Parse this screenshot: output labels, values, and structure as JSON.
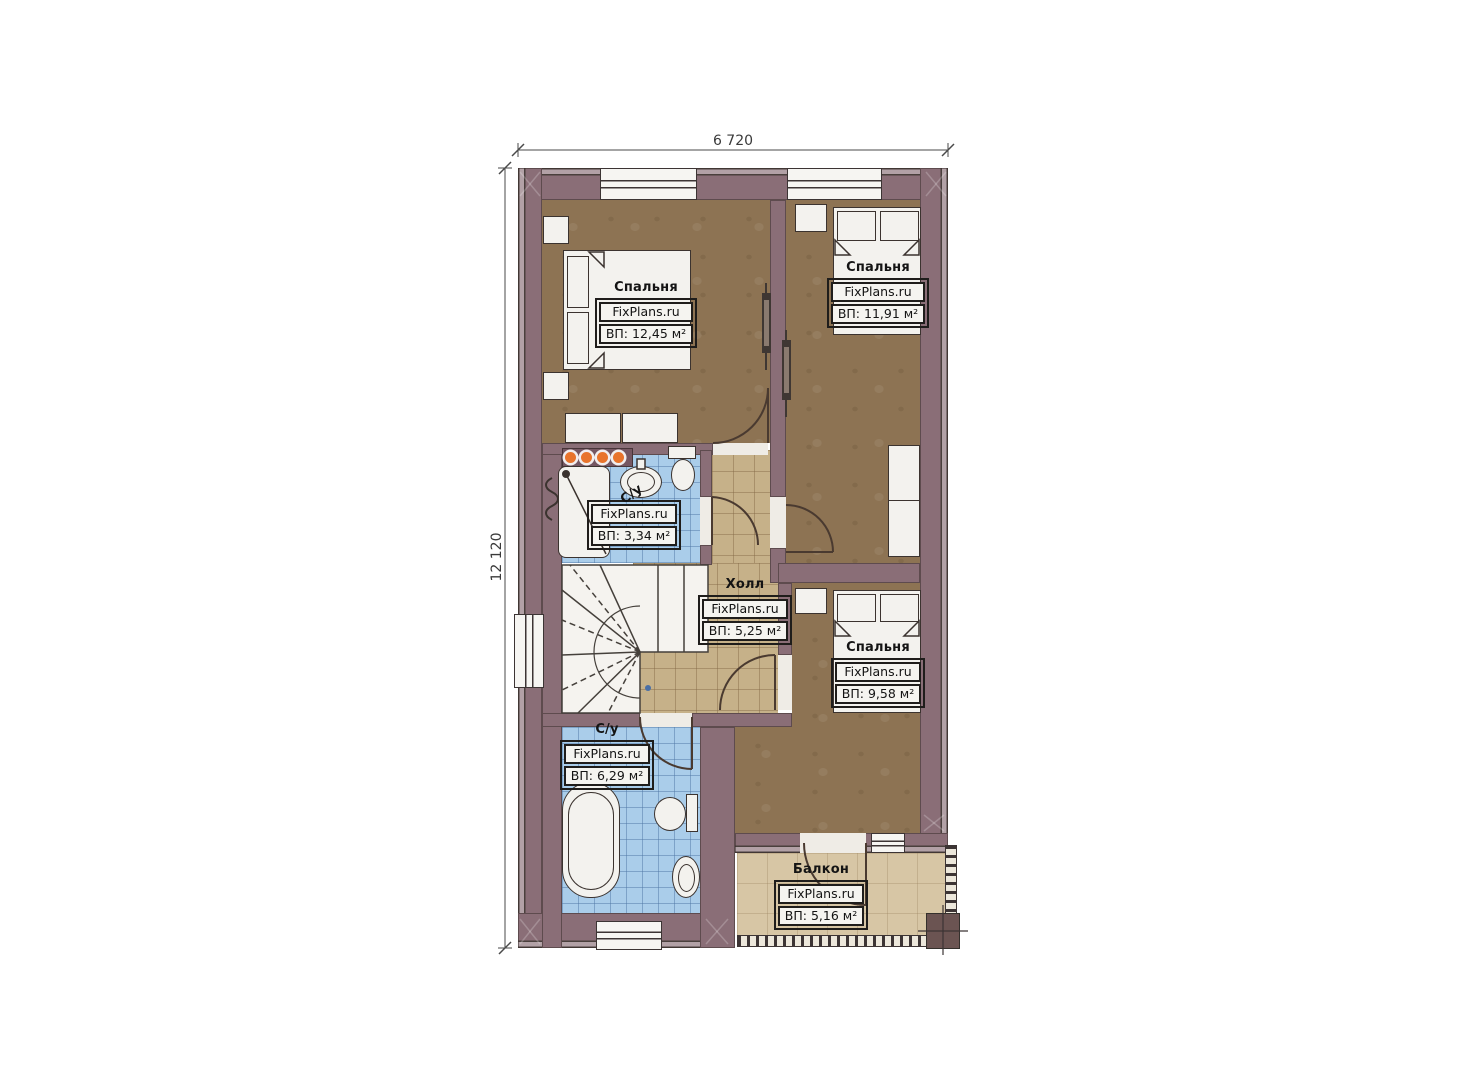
{
  "plan_title": "floor-plan-second-level",
  "brand": "FixPlans.ru",
  "dimensions": {
    "width_label": "6 720",
    "height_label": "12 120"
  },
  "colors": {
    "wall": "#8a6e77",
    "wood_floor": "#8d7353",
    "hall_tile": "#c6b189",
    "bath_tile": "#aacdea",
    "balcony_floor": "#d7c6a5",
    "spotlight_accent": "#e8742c"
  },
  "rooms": {
    "bedroom_top_left": {
      "name": "Спальня",
      "brand": "FixPlans.ru",
      "area": "ВП: 12,45 м²"
    },
    "bedroom_top_right": {
      "name": "Спальня",
      "brand": "FixPlans.ru",
      "area": "ВП: 11,91 м²"
    },
    "bathroom_small": {
      "name": "С/у",
      "brand": "FixPlans.ru",
      "area": "ВП: 3,34 м²"
    },
    "hall": {
      "name": "Холл",
      "brand": "FixPlans.ru",
      "area": "ВП: 5,25 м²"
    },
    "bedroom_bottom_right": {
      "name": "Спальня",
      "brand": "FixPlans.ru",
      "area": "ВП: 9,58 м²"
    },
    "bathroom_big": {
      "name": "С/у",
      "brand": "FixPlans.ru",
      "area": "ВП: 6,29 м²"
    },
    "balcony": {
      "name": "Балкон",
      "brand": "FixPlans.ru",
      "area": "ВП: 5,16 м²"
    }
  }
}
